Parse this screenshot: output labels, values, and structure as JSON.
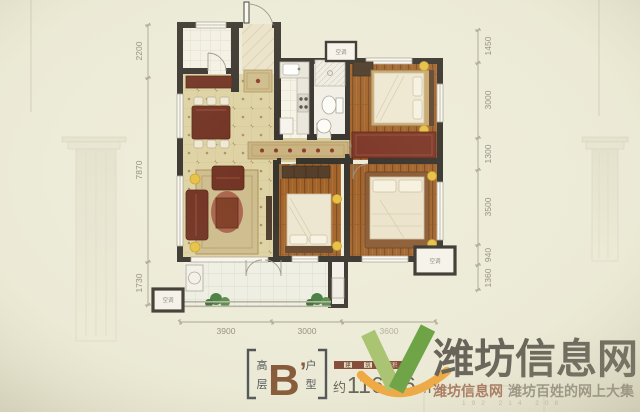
{
  "floorplan": {
    "dims_left": [
      "2200",
      "7870",
      "1730"
    ],
    "dims_right": [
      "1450",
      "3000",
      "1300",
      "3500",
      "940",
      "1360"
    ],
    "dims_bottom": [
      "3900",
      "3000",
      "3600"
    ],
    "ac_label": "空调"
  },
  "unit": {
    "floor_char1": "高",
    "floor_char2": "层",
    "type_letter": "B",
    "type_prime": "’",
    "type_char1": "户",
    "type_char2": "型",
    "area_bar_char1": "建",
    "area_bar_char2": "筑",
    "area_bar_rest": "面积",
    "area_prefix": "约",
    "area_value": "116.06",
    "area_unit": "m",
    "area_sup": "2"
  },
  "watermark": {
    "site_name": "潍坊信息网",
    "tagline_brand": "潍坊信息网",
    "tagline_slogan": "潍坊百姓的网上大集",
    "faint_numbers": "192    214    208"
  },
  "colors": {
    "wall": "#36322c",
    "wood": "#a2632a",
    "tile": "#ded2a3",
    "maroon": "#6f2f1f",
    "logo_green": "#5f9c36",
    "logo_green_light": "#a3c168",
    "logo_orange": "#f2a332",
    "watermark_gray": "#57534b",
    "tagline_red": "#a06a52",
    "lamp_yellow": "#e7c143"
  }
}
